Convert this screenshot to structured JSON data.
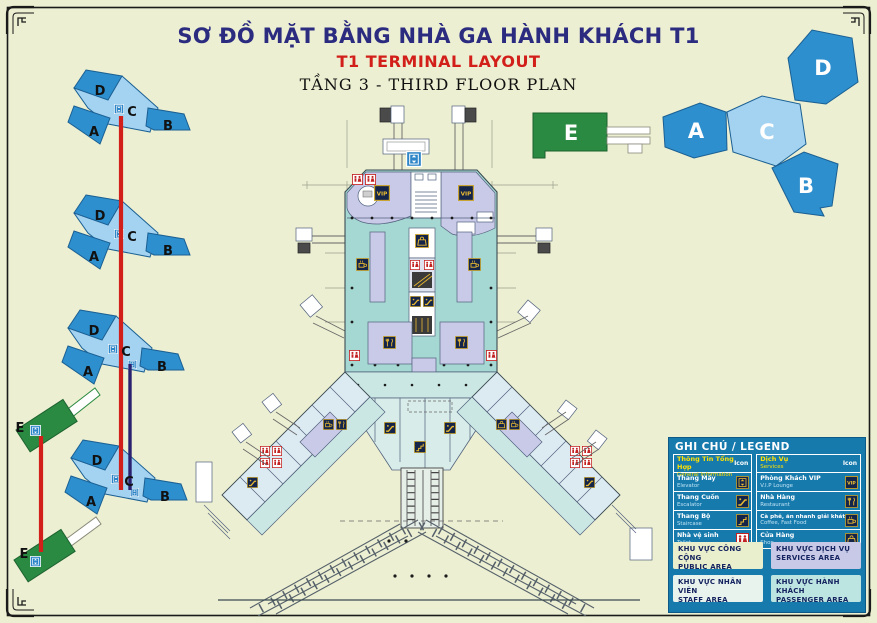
{
  "title": {
    "vi": "SƠ ĐỒ MẶT BẰNG NHÀ GA HÀNH KHÁCH T1",
    "en": "T1 TERMINAL LAYOUT",
    "floor": "TẦNG 3 - THIRD FLOOR PLAN"
  },
  "overview_icon": {
    "labels": {
      "a": "A",
      "b": "B",
      "c": "C",
      "d": "D",
      "e": "E"
    }
  },
  "floor_stack": {
    "floors": [
      {
        "a": "A",
        "b": "B",
        "c": "C",
        "d": "D"
      },
      {
        "a": "A",
        "b": "B",
        "c": "C",
        "d": "D"
      },
      {
        "a": "A",
        "b": "B",
        "c": "C",
        "d": "D"
      },
      {
        "a": "A",
        "b": "B",
        "c": "C",
        "d": "D"
      }
    ],
    "e_labels": [
      "E",
      "E"
    ]
  },
  "icons": {
    "vip_label": "VIP"
  },
  "legend": {
    "title": "GHI CHÚ / LEGEND",
    "icon_col": "Icon",
    "general": {
      "vi": "Thông Tin Tổng Hợp",
      "en": "General Information",
      "items": [
        {
          "vi": "Thang Máy",
          "en": "Elevator",
          "icon": "elevator-icon"
        },
        {
          "vi": "Thang Cuốn",
          "en": "Escalator",
          "icon": "escalator-icon"
        },
        {
          "vi": "Thang Bộ",
          "en": "Staircase",
          "icon": "staircase-icon"
        },
        {
          "vi": "Nhà vệ sinh",
          "en": "Toilet",
          "icon": "toilet-icon"
        }
      ]
    },
    "services": {
      "vi": "Dịch Vụ",
      "en": "Services",
      "items": [
        {
          "vi": "Phòng Khách VIP",
          "en": "V.I.P Lounge",
          "icon": "vip-icon"
        },
        {
          "vi": "Nhà Hàng",
          "en": "Restaurant",
          "icon": "restaurant-icon"
        },
        {
          "vi": "Cà phê, ăn nhanh giải khát",
          "en": "Coffee, Fast Food",
          "icon": "coffee-icon"
        },
        {
          "vi": "Cửa Hàng",
          "en": "Shop",
          "icon": "shop-icon"
        }
      ]
    },
    "areas": [
      {
        "vi": "KHU VỰC CÔNG CỘNG",
        "en": "PUBLIC AREA",
        "color": "#E9EFCC"
      },
      {
        "vi": "KHU VỰC DỊCH VỤ",
        "en": "SERVICES  AREA",
        "color": "#C8C9E7"
      },
      {
        "vi": "KHU VỰC NHÂN VIÊN",
        "en": "STAFF AREA",
        "color": "#E8F3EE"
      },
      {
        "vi": "KHU VỰC HÀNH KHÁCH",
        "en": "PASSENGER AREA",
        "color": "#BCE4E0"
      }
    ]
  },
  "colors": {
    "background": "#ECEFD1",
    "title_navy": "#2B2B80",
    "title_red": "#D21F1A",
    "legend_panel_blue": "#177AAD",
    "legend_yellow": "#FFE100",
    "terminal_dark_blue": "#2E8FCE",
    "terminal_light_blue": "#A4D3F2",
    "terminal_green": "#2B8A41",
    "plan_lavender": "#C9CAE8",
    "plan_cyan": "#A6D8D3",
    "line_red": "#D21F1A",
    "line_navy": "#2A2270"
  }
}
